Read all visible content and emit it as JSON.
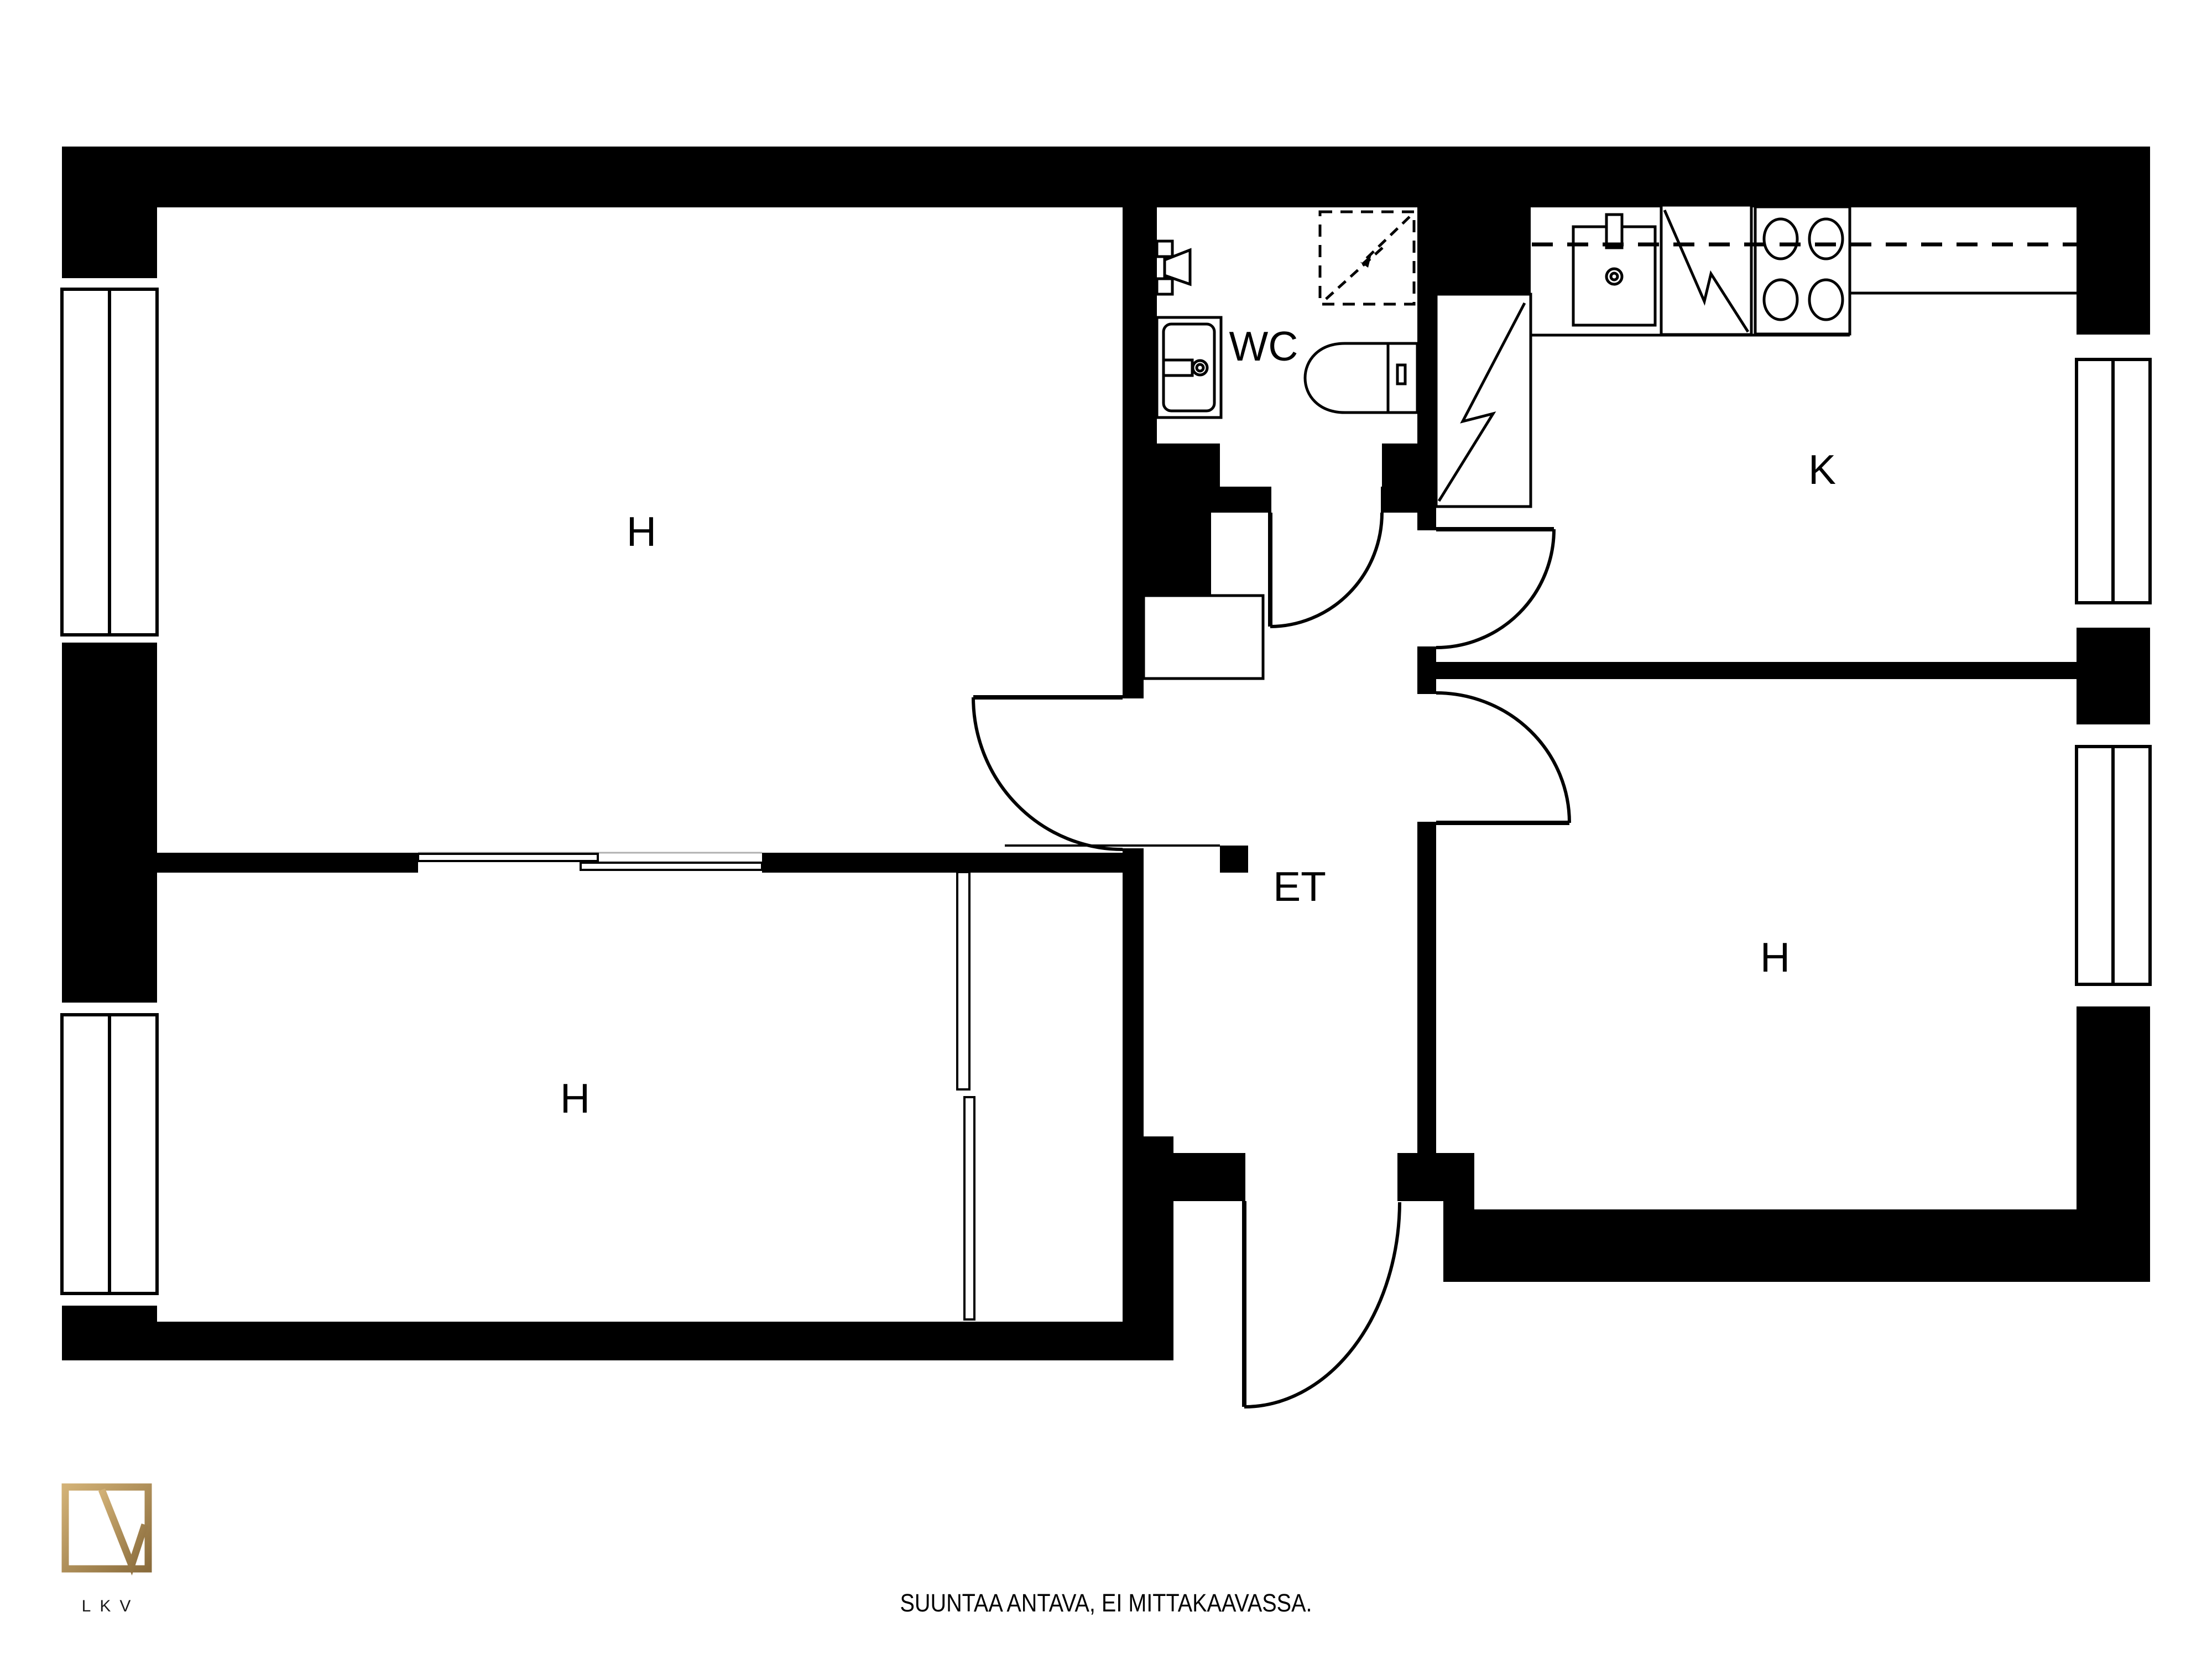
{
  "rooms": {
    "h_top_left": "H",
    "h_bottom_left": "H",
    "h_right": "H",
    "kitchen": "K",
    "wc": "WC",
    "hall": "ET"
  },
  "footer": {
    "disclaimer": "SUUNTAA ANTAVA, EI MITTAKAAVASSA."
  },
  "logo": {
    "text": "LKV"
  },
  "colors": {
    "wall": "#000000",
    "line": "#000000",
    "background": "#ffffff",
    "track_gray": "#b0b0b0",
    "logo_gold_light": "#d2b176",
    "logo_gold_dark": "#8a6c3c"
  }
}
